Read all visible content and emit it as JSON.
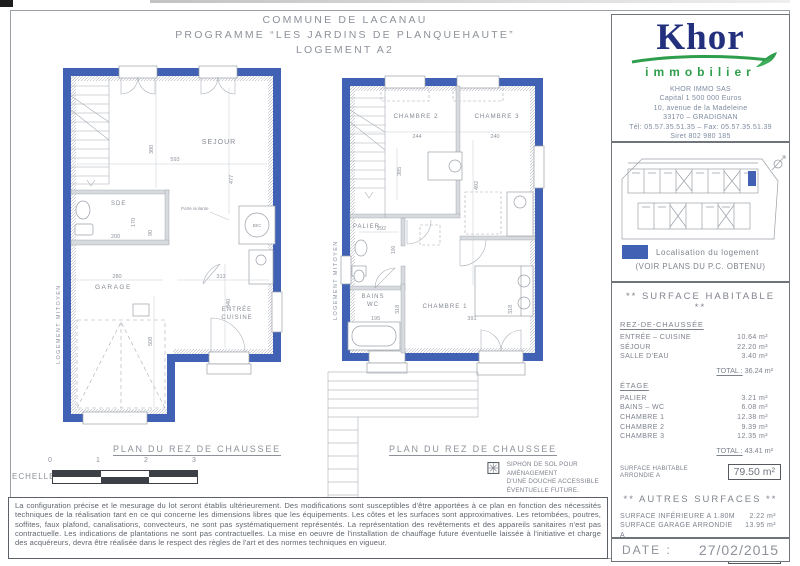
{
  "title": {
    "line1": "COMMUNE DE LACANAU",
    "line2": "PROGRAMME “LES JARDINS DE PLANQUEHAUTE”",
    "line3": "LOGEMENT A2"
  },
  "plans": {
    "ground": {
      "label": "PLAN DU REZ DE CHAUSSEE",
      "party_wall": "LOGEMENT MITOYEN",
      "rooms": {
        "sejour": "SEJOUR",
        "sde": "SDE",
        "garage": "GARAGE",
        "entree": "ENTRÉE",
        "cuisine": "CUISINE"
      },
      "annotations": {
        "porte": "Porte isolante",
        "bec": "BEC"
      },
      "dims": {
        "d380": "380",
        "d593": "593",
        "d477": "477",
        "d170": "170",
        "d200": "200",
        "d90": "90",
        "d280": "280",
        "d313": "313",
        "d340": "340",
        "d508": "508"
      }
    },
    "upper": {
      "label": "PLAN DU REZ DE CHAUSSEE",
      "party_wall": "LOGEMENT MITOYEN",
      "rooms": {
        "chambre2": "CHAMBRE 2",
        "chambre3": "CHAMBRE 3",
        "palier": "PALIER",
        "bains": "BAINS",
        "wc": "WC",
        "chambre1": "CHAMBRE 1"
      },
      "dims": {
        "d244": "244",
        "d240": "240",
        "d492": "492",
        "d385": "385",
        "d292": "292",
        "d100": "100",
        "d318a": "318",
        "d318b": "318",
        "d195": "195",
        "d391": "391"
      }
    }
  },
  "echelle": {
    "label": "ECHELLE",
    "ticks": [
      "0",
      "1",
      "2",
      "3"
    ]
  },
  "siphon_note": {
    "line1": "SIPHON DE SOL POUR AMÉNAGEMENT",
    "line2": "D'UNE DOUCHE ACCESSIBLE",
    "line3": "ÉVENTUELLE FUTURE."
  },
  "disclaimer": "La configuration précise et le mesurage du lot seront établis ultérieurement. Des modifications sont susceptibles d'être apportées à ce plan en fonction des nécessités techniques de la réalisation tant en ce qui concerne les dimensions libres que les équipements. Les côtes et les surfaces sont approximatives. Les retombées, poutres, soffites, faux plafond, canalisations, convecteurs, ne sont pas systématiquement représentés. La représentation des revêtements et des appareils sanitaires n'est pas contractuelle. Les indications de plantations ne sont pas contractuelles. La mise en oeuvre de l'installation de chauffage future éventuelle laissée à l'initiative et charge des acquéreurs, devra être réalisée dans le respect des règles de l'art et des normes techniques en vigueur.",
  "sidebar": {
    "logo": {
      "name": "Khor",
      "sub": "immobilier"
    },
    "company": [
      "KHOR IMMO SAS",
      "Capital 1 500 000 Euros",
      "10, avenue de la Madeleine",
      "33170 – GRADIGNAN",
      "Tél: 05.57.35.51.35 – Fax: 05.57.35.51.39",
      "Siret 802 980 185",
      "RCS Versailles B 319 086 963"
    ],
    "localisation": {
      "legend": "Localisation du logement",
      "note": "(VOIR PLANS DU P.C. OBTENU)"
    },
    "surfaces": {
      "title": "** SURFACE HABITABLE **",
      "rdc_header": "REZ-DE-CHAUSSÉE",
      "rdc_rows": [
        [
          "ENTRÉE – CUISINE",
          "10.64 m²"
        ],
        [
          "SÉJOUR",
          "22.20 m²"
        ],
        [
          "SALLE D'EAU",
          "3.40 m²"
        ]
      ],
      "rdc_total_label": "TOTAL :",
      "rdc_total": "36.24 m²",
      "etage_header": "ÉTAGE",
      "etage_rows": [
        [
          "PALIER",
          "3.21 m²"
        ],
        [
          "BAINS – WC",
          "6.08 m²"
        ],
        [
          "CHAMBRE 1",
          "12.38 m²"
        ],
        [
          "CHAMBRE 2",
          "9.39 m²"
        ],
        [
          "CHAMBRE 3",
          "12.35 m²"
        ]
      ],
      "etage_total_label": "TOTAL :",
      "etage_total": "43.41 m²",
      "habitable_label": "SURFACE HABITABLE ARRONDIE A",
      "habitable_value": "79.50 m²",
      "autres_title": "** AUTRES SURFACES **",
      "autres_rows": [
        [
          "SURFACE INFÉRIEURE A 1.80M",
          "2.22 m²"
        ],
        [
          "SURFACE GARAGE ARRONDIE A",
          "13.95 m²"
        ]
      ],
      "utilisable_label": "SURFACE UTILISABLE ARRONDIE A",
      "utilisable_value": "95.50 m²"
    },
    "date": {
      "label": "DATE :",
      "value": "27/02/2015"
    }
  },
  "colors": {
    "wall_blue": "#4161b4",
    "logo_navy": "#23307e",
    "logo_green": "#2f9e4c"
  }
}
